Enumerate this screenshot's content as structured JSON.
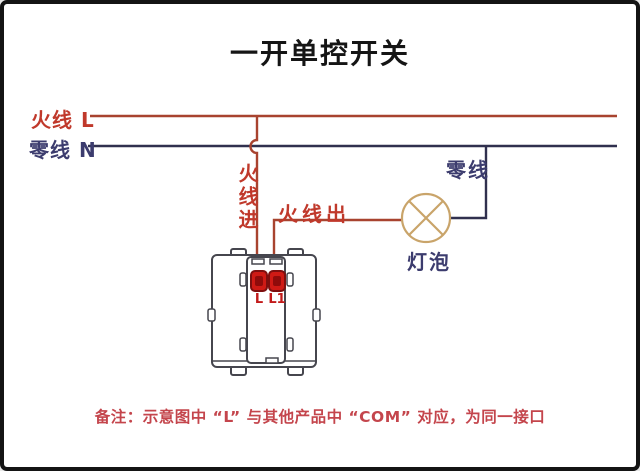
{
  "title": "一开单控开关",
  "wires": {
    "live_label": "火线 L",
    "neutral_label": "零线 N",
    "live_in_label": "火线进",
    "live_out_label": "火线出",
    "neutral_right_label": "零线"
  },
  "bulb": {
    "label": "灯泡"
  },
  "switch": {
    "terminal_l": "L",
    "terminal_l1": "L1"
  },
  "note": "备注：示意图中 “L” 与其他产品中 “COM” 对应，为同一接口",
  "colors": {
    "live_wire": "#a8432f",
    "neutral_wire": "#30304e",
    "red_label": "#c0392b",
    "navy_label": "#3c3c6e",
    "bulb_outline": "#c9a46a",
    "switch_outline": "#46464e",
    "terminal_fill": "#cf1a15",
    "terminal_border": "#7e0f0f",
    "terminal_inner": "#8f0b0b",
    "note_color": "#c4454c",
    "title_color": "#151515",
    "frame_border": "#141414"
  }
}
